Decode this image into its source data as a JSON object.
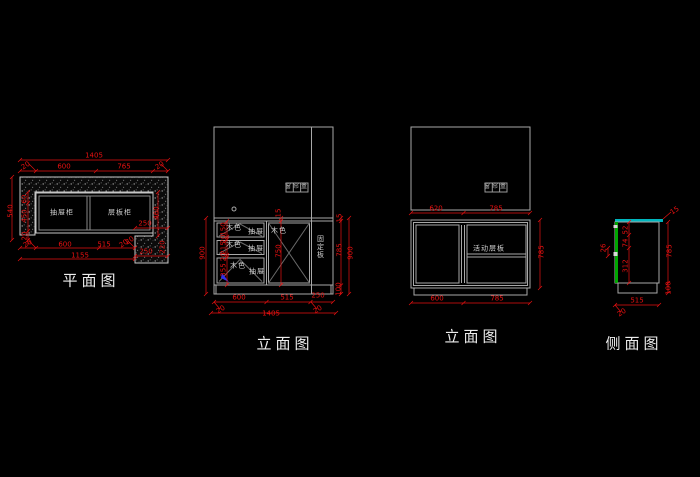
{
  "plan": {
    "title": "平面图",
    "drawer_cabinet": "抽屉柜",
    "shelf_cabinet": "层板柜",
    "dim_total_top": "1405",
    "dim_wall_left": "20",
    "dim_600_top": "600",
    "dim_765": "765",
    "dim_wall_right": "20",
    "dim_depth": "540",
    "dim_left_60": "60",
    "dim_left_450": "450",
    "dim_left_20": "20",
    "dim_right_460": "460",
    "dim_notch_250_top": "250",
    "dim_notch_20": "20",
    "dim_notch_220": "220",
    "dim_notch_250_bot": "250",
    "dim_bot_20_left": "20",
    "dim_bot_600": "600",
    "dim_bot_515": "515",
    "dim_bot_20_right": "20",
    "dim_bot_total": "1155"
  },
  "elev1": {
    "title": "立面图",
    "curtain_box": "窗帘盒",
    "wood": "木色",
    "drawer": "抽屉",
    "fixed_panel": "固定板",
    "dim_left_900": "900",
    "dim_150": "150",
    "dim_20_a": "20",
    "dim_215": "215",
    "dim_20_b": "20",
    "dim_355": "355",
    "dim_mid_15": "15",
    "dim_mid_750": "750",
    "dim_right_15": "15",
    "dim_right_785": "785",
    "dim_right_100": "100",
    "dim_right_900": "900",
    "dim_bot_600": "600",
    "dim_bot_515": "515",
    "dim_bot_250": "250",
    "dim_bot_20_left": "20",
    "dim_bot_20_right": "20",
    "dim_bot_total": "1405"
  },
  "elev2": {
    "title": "立面图",
    "curtain_box": "窗帘盒",
    "movable_shelf": "活动层板",
    "dim_top_620": "620",
    "dim_top_785": "785",
    "dim_right_785": "785",
    "dim_bot_600": "600",
    "dim_bot_785": "785"
  },
  "side": {
    "title": "侧面图",
    "dim_top_15": "15",
    "dim_right_785": "785",
    "dim_base_100": "100",
    "dim_bot_515": "515",
    "dim_bot_20": "20",
    "dim_left_26": "26",
    "dim_52": "52",
    "dim_74": "74",
    "dim_312": "312"
  },
  "colors": {
    "background": "#000000",
    "dimension": "#e81010",
    "line": "#aaaaaa",
    "wall_hatch": "#9a9a9a",
    "top_edge_cyan": "#00b6be",
    "side_edge_green": "#00a600",
    "marker_blue": "#2d2df0"
  }
}
